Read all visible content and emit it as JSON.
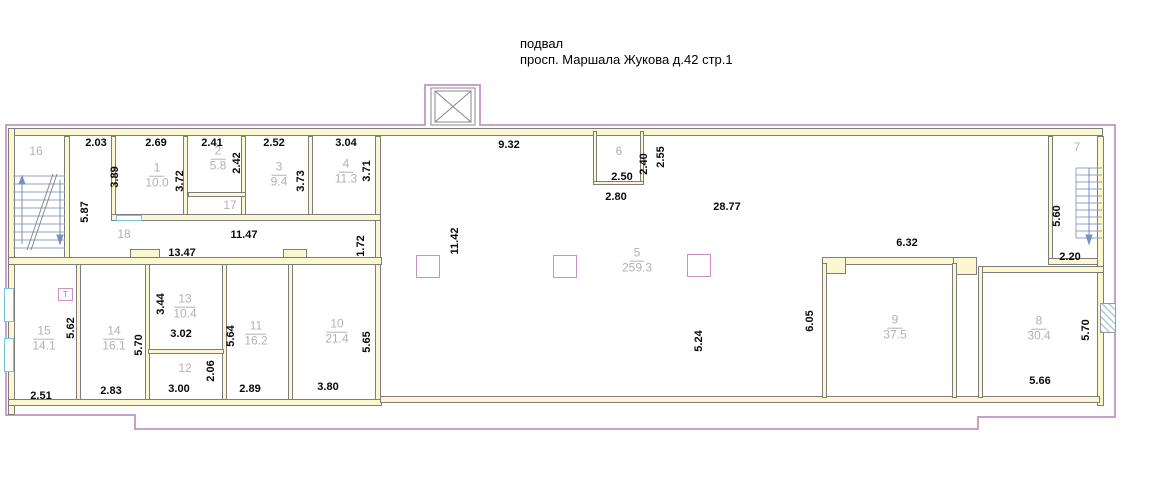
{
  "title": {
    "building_level": "подвал",
    "address": "просп. Маршала Жукова д.42 стр.1"
  },
  "rooms": [
    {
      "number": "16",
      "area": ""
    },
    {
      "number": "1",
      "area": "10.0"
    },
    {
      "number": "2",
      "area": "5.8"
    },
    {
      "number": "3",
      "area": "9.4"
    },
    {
      "number": "4",
      "area": "11.3"
    },
    {
      "number": "17",
      "area": ""
    },
    {
      "number": "18",
      "area": ""
    },
    {
      "number": "6",
      "area": ""
    },
    {
      "number": "5",
      "area": "259.3"
    },
    {
      "number": "7",
      "area": ""
    },
    {
      "number": "9",
      "area": "37.5"
    },
    {
      "number": "8",
      "area": "30.4"
    },
    {
      "number": "15",
      "area": "14.1"
    },
    {
      "number": "14",
      "area": "16.1"
    },
    {
      "number": "13",
      "area": "10.4"
    },
    {
      "number": "12",
      "area": ""
    },
    {
      "number": "11",
      "area": "16.2"
    },
    {
      "number": "10",
      "area": "21.4"
    }
  ],
  "dimensions": [
    {
      "value": "2.03"
    },
    {
      "value": "2.69"
    },
    {
      "value": "2.41"
    },
    {
      "value": "2.52"
    },
    {
      "value": "3.04"
    },
    {
      "value": "9.32"
    },
    {
      "value": "3.89"
    },
    {
      "value": "5.87"
    },
    {
      "value": "3.72"
    },
    {
      "value": "2.42"
    },
    {
      "value": "3.73"
    },
    {
      "value": "3.71"
    },
    {
      "value": "11.47"
    },
    {
      "value": "13.47"
    },
    {
      "value": "1.72"
    },
    {
      "value": "11.42"
    },
    {
      "value": "2.50"
    },
    {
      "value": "2.40"
    },
    {
      "value": "2.55"
    },
    {
      "value": "2.80"
    },
    {
      "value": "28.77"
    },
    {
      "value": "6.32"
    },
    {
      "value": "5.60"
    },
    {
      "value": "2.20"
    },
    {
      "value": "6.05"
    },
    {
      "value": "5.24"
    },
    {
      "value": "5.62"
    },
    {
      "value": "2.51"
    },
    {
      "value": "5.70"
    },
    {
      "value": "2.83"
    },
    {
      "value": "3.44"
    },
    {
      "value": "3.02"
    },
    {
      "value": "3.00"
    },
    {
      "value": "2.06"
    },
    {
      "value": "5.64"
    },
    {
      "value": "2.89"
    },
    {
      "value": "5.65"
    },
    {
      "value": "3.80"
    },
    {
      "value": "5.70"
    },
    {
      "value": "5.66"
    }
  ],
  "markers": {
    "t_marker": "T"
  },
  "colors": {
    "boundary": "#c9a0c9",
    "wall_fill": "#fbf7cf",
    "wall_line": "#7d7d7d",
    "dim_text": "#0a0a0a",
    "room_label": "#b2b2b2",
    "stairs": "#8fa0c8",
    "window": "#72c8da",
    "column": "#c98fc9"
  }
}
